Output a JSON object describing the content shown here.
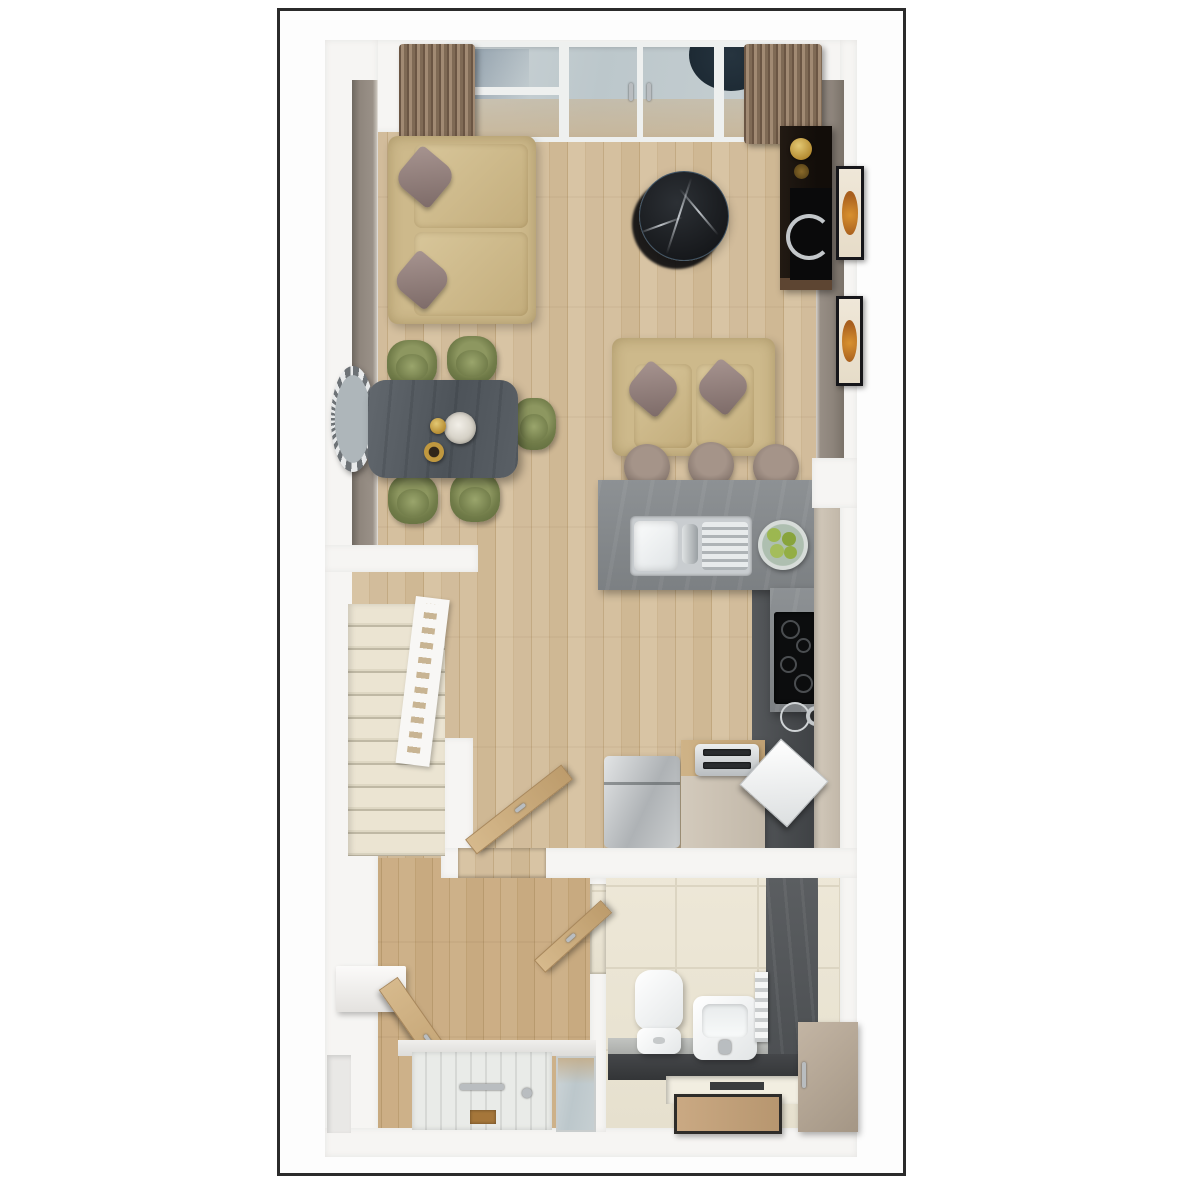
{
  "image": {
    "kind": "3d-floor-plan-top-view",
    "label": "Ground floor 3D floor plan, portrait orientation, framed on white",
    "frame_border_color": "#2b2b2b",
    "background": "#ffffff"
  },
  "palette": {
    "wall_white": "#f6f5f3",
    "wall_taupe": "#8f867d",
    "floor_wood": "#cfb894",
    "floor_wood_hall": "#c4a77c",
    "floor_tile_cream": "#eae4d3",
    "kitchen_dark_floor": "#4b4e51",
    "sofa_beige": "#cdb98b",
    "cushion_mauve": "#93807d",
    "chair_olive": "#717c49",
    "dining_table_gray": "#565c62",
    "island_gray": "#85898c",
    "coffee_table_marble": "#191b1e",
    "curtain_brown": "#826c57",
    "stair_carpet_cream": "#e5decb",
    "slate_feature_wall": "#525558",
    "cabinet_taupe": "#b2a494",
    "door_wood": "#c9a87c",
    "accent_gold": "#c9a84c",
    "apples_green": "#9cb750"
  },
  "rooms": {
    "living": {
      "label": "Living area",
      "items": [
        "two-seat sofa with two mauve cushions (left)",
        "two-seat sofa with two mauve cushions (centre)",
        "round black marble coffee table",
        "dark media unit with television and gold lamp",
        "two framed pictures on right wall",
        "glazed patio doors with brown curtains"
      ]
    },
    "dining": {
      "label": "Dining area",
      "items": [
        "dark rectangular dining table",
        "five olive-green chairs",
        "round wall mirror",
        "table decor: hydrangea ball, gold vase, gold tealight"
      ]
    },
    "kitchen": {
      "label": "Kitchen",
      "items": [
        "grey breakfast island with inset double sink and drainer",
        "three upholstered bar stools",
        "glass bowl of green apples",
        "induction hob",
        "kettle and pot",
        "fridge",
        "beige unit with toaster",
        "open dishwasher door in corner",
        "tall beige cabinet run",
        "dark tiled work zone"
      ]
    },
    "stairs": {
      "label": "Staircase",
      "items": [
        "cream carpeted treads",
        "white banister with balusters",
        "under-stair cupboard with open wooden door"
      ]
    },
    "hallway": {
      "label": "Hallway",
      "items": [
        "white panelled front door with letter plate",
        "glazed side panel",
        "white console shelf",
        "open wooden door to living area"
      ]
    },
    "bathroom": {
      "label": "Cloakroom WC",
      "items": [
        "toilet",
        "square wash basin",
        "white towel rail on slate feature wall",
        "taupe storage cabinet",
        "sunken tray with wooden mat",
        "cream floor tiles"
      ]
    }
  }
}
